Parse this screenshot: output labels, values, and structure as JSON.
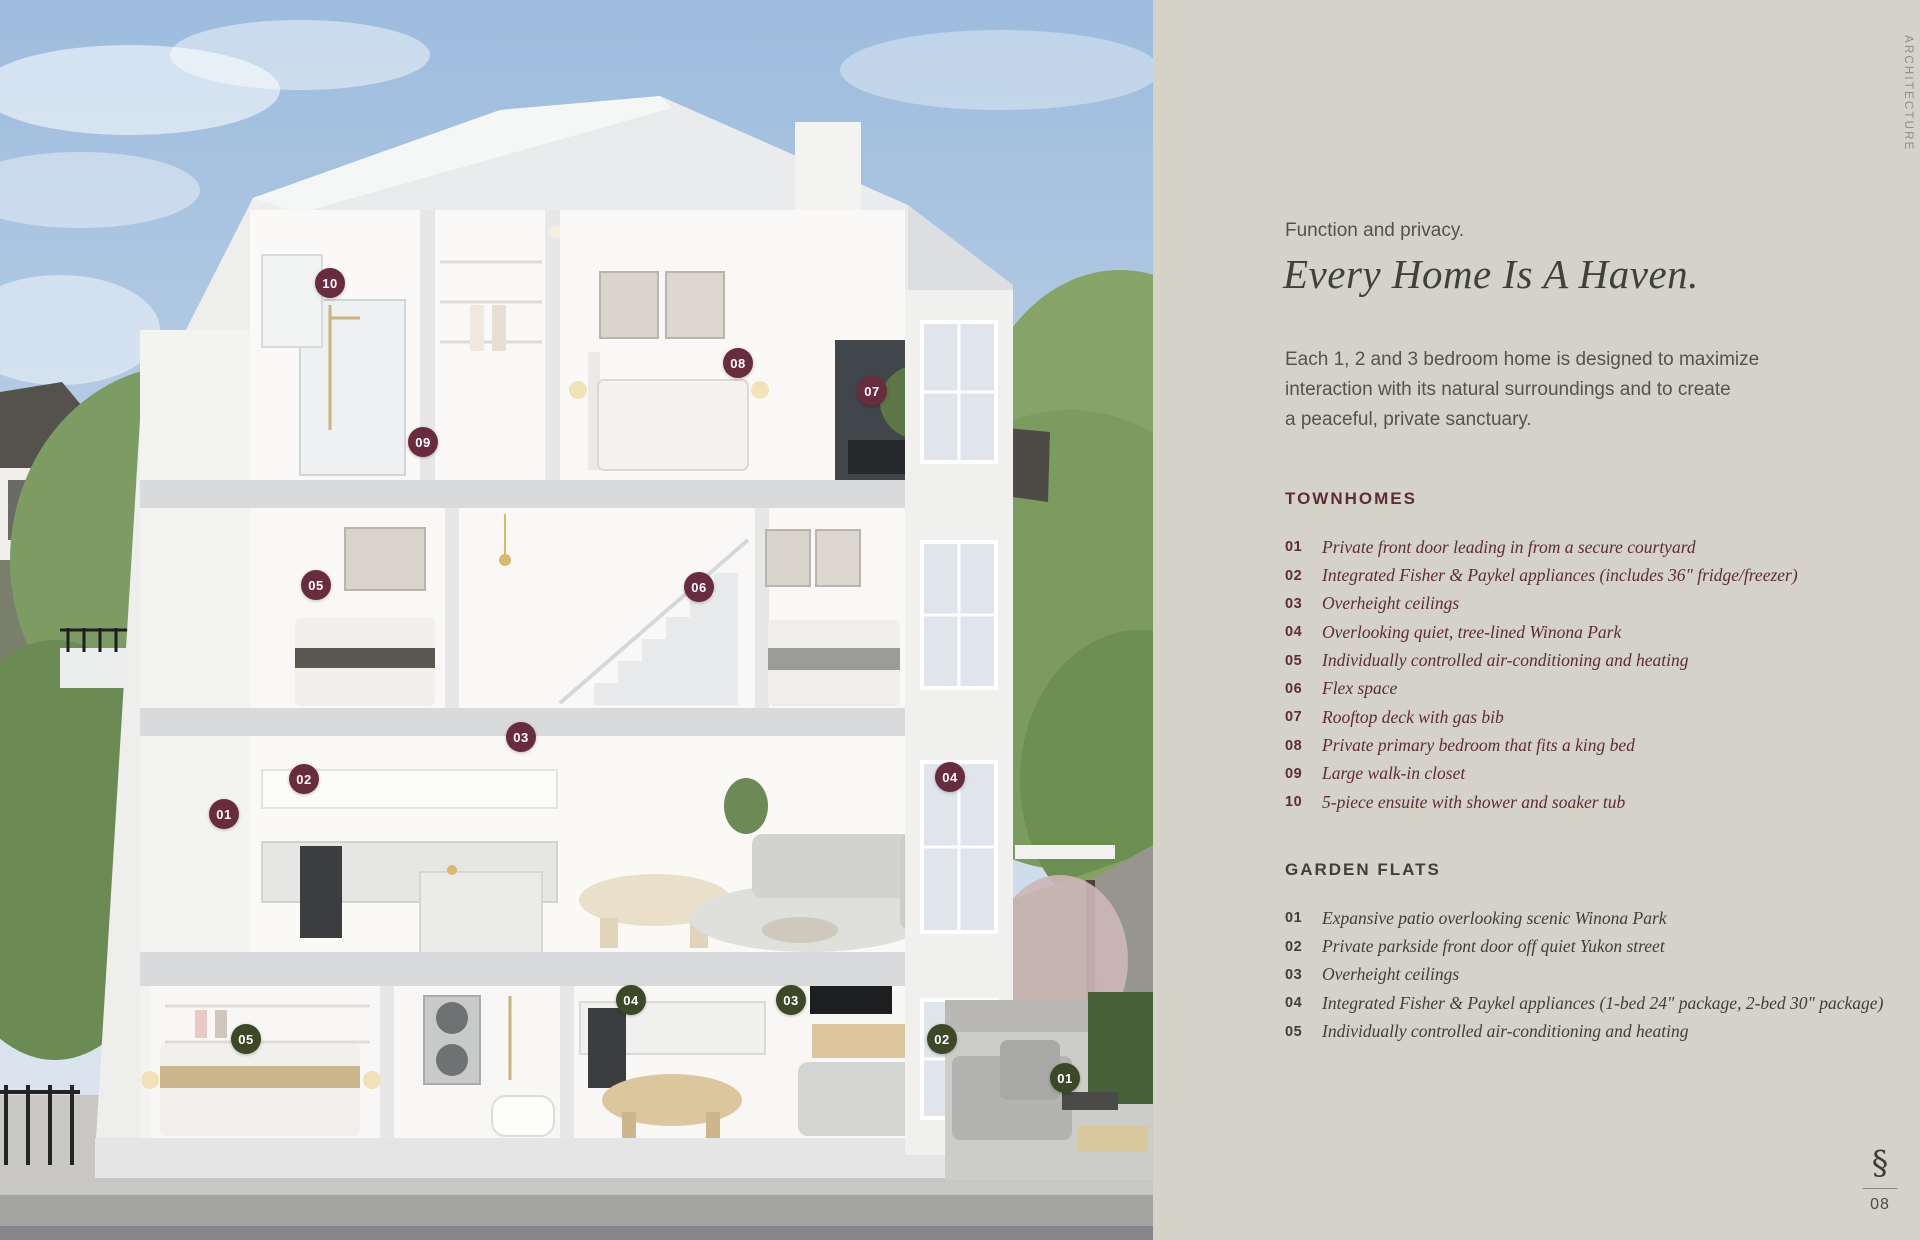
{
  "side_label": "ARCHITECTURE",
  "header": {
    "eyebrow": "Function and privacy.",
    "title": "Every Home Is A Haven."
  },
  "intro_lines": [
    "Each 1, 2 and 3 bedroom home is designed to maximize",
    "interaction with its natural surroundings and to create",
    "a peaceful, private sanctuary."
  ],
  "sections": [
    {
      "heading": "TOWNHOMES",
      "theme": "maroon",
      "items": [
        {
          "num": "01",
          "text": "Private front door leading in from a secure courtyard"
        },
        {
          "num": "02",
          "text": "Integrated Fisher & Paykel appliances (includes 36\" fridge/freezer)"
        },
        {
          "num": "03",
          "text": "Overheight ceilings"
        },
        {
          "num": "04",
          "text": "Overlooking quiet, tree-lined Winona Park"
        },
        {
          "num": "05",
          "text": "Individually controlled air-conditioning and heating"
        },
        {
          "num": "06",
          "text": "Flex space"
        },
        {
          "num": "07",
          "text": "Rooftop deck with gas bib"
        },
        {
          "num": "08",
          "text": "Private primary bedroom that fits a king bed"
        },
        {
          "num": "09",
          "text": "Large walk-in closet"
        },
        {
          "num": "10",
          "text": "5-piece ensuite with shower and soaker tub"
        }
      ]
    },
    {
      "heading": "GARDEN FLATS",
      "theme": "olive",
      "items": [
        {
          "num": "01",
          "text": "Expansive patio overlooking scenic Winona Park"
        },
        {
          "num": "02",
          "text": "Private parkside front door off quiet Yukon street"
        },
        {
          "num": "03",
          "text": "Overheight ceilings"
        },
        {
          "num": "04",
          "text": "Integrated Fisher & Paykel appliances (1-bed 24\" package, 2-bed 30\" package)"
        },
        {
          "num": "05",
          "text": "Individually controlled air-conditioning and heating"
        }
      ]
    }
  ],
  "badges": {
    "townhomes": [
      {
        "label": "01",
        "x": 224,
        "y": 814
      },
      {
        "label": "02",
        "x": 304,
        "y": 779
      },
      {
        "label": "03",
        "x": 521,
        "y": 737
      },
      {
        "label": "04",
        "x": 950,
        "y": 777
      },
      {
        "label": "05",
        "x": 316,
        "y": 585
      },
      {
        "label": "06",
        "x": 699,
        "y": 587
      },
      {
        "label": "07",
        "x": 872,
        "y": 391
      },
      {
        "label": "08",
        "x": 738,
        "y": 363
      },
      {
        "label": "09",
        "x": 423,
        "y": 442
      },
      {
        "label": "10",
        "x": 330,
        "y": 283
      }
    ],
    "garden_flats": [
      {
        "label": "01",
        "x": 1065,
        "y": 1078
      },
      {
        "label": "02",
        "x": 942,
        "y": 1039
      },
      {
        "label": "03",
        "x": 791,
        "y": 1000
      },
      {
        "label": "04",
        "x": 631,
        "y": 1000
      },
      {
        "label": "05",
        "x": 246,
        "y": 1039
      }
    ]
  },
  "footer": {
    "logo_glyph": "§",
    "page_number": "08"
  },
  "colors": {
    "maroon_badge": "#682c3e",
    "olive_badge": "#3c4826",
    "panel_bg": "#d5d2c8",
    "heading_text": "#3e4237",
    "townhome_text": "#5d2c3a",
    "garden_text": "#3d4134"
  }
}
